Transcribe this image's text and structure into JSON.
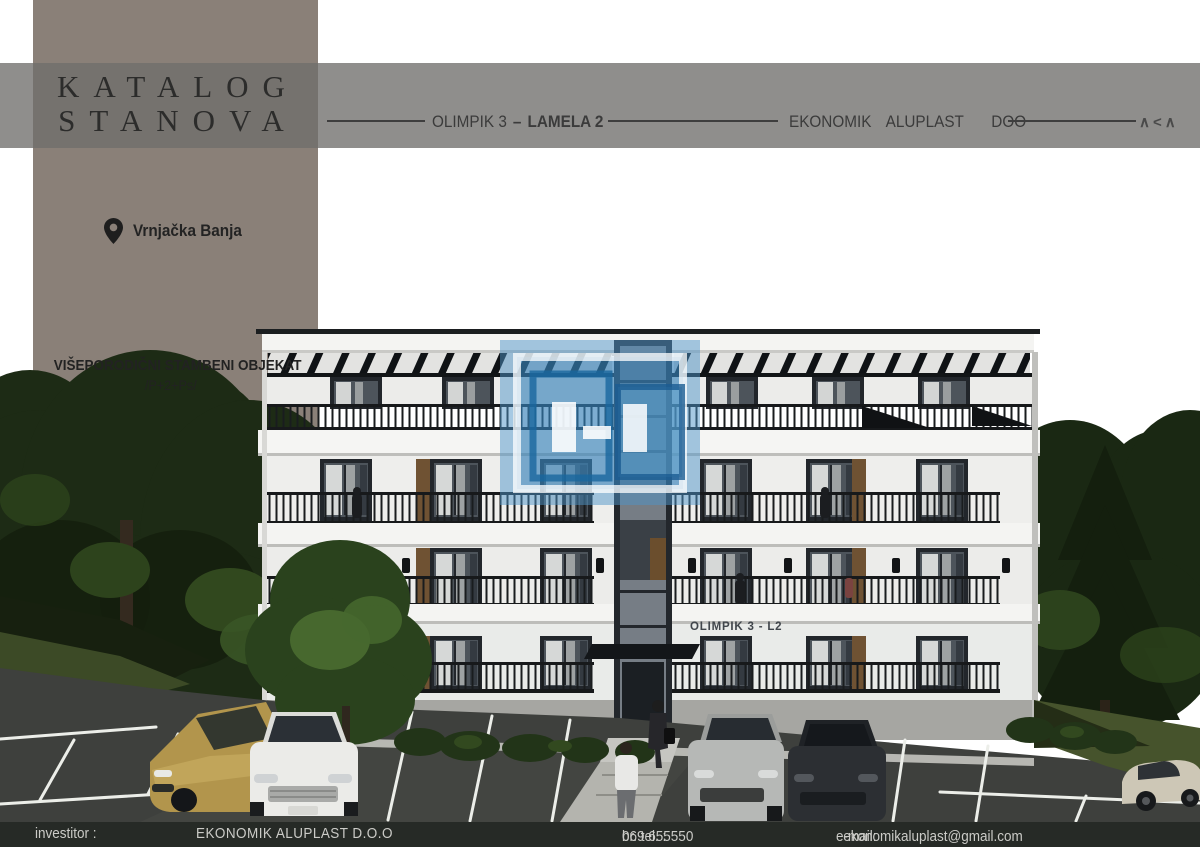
{
  "branding": {
    "catalog_title_line1": "KATALOG",
    "catalog_title_line2": "STANOVA"
  },
  "header": {
    "project_name": "OLIMPIK 3",
    "separator": "–",
    "building_name": "LAMELA 2",
    "company": "EKONOMIK ALUPLAST",
    "company_suffix": "DOO",
    "logo_mark": "∧<∧"
  },
  "location": {
    "label": "Vrnjačka Banja"
  },
  "building_info": {
    "type_label": "VIŠEPORODIČNI STAMBENI OBJEKAT",
    "floors_label": "/P+2+Ps/"
  },
  "render": {
    "building_sign": "OLIMPIK 3 - L2"
  },
  "footer": {
    "investor_label": "investitor :",
    "investor_name": "EKONOMIK ALUPLAST D.O.O",
    "phone_label": "br. tel. :",
    "phone_number": "069 655550",
    "email_label": "e-mail:",
    "email": "ekonomikaluplast@gmail.com"
  },
  "colors": {
    "taupe_block": "#8a8078",
    "band_gray": "#706e6c",
    "footer_bar": "#262a26",
    "accent_blue": "#4e94c8"
  }
}
